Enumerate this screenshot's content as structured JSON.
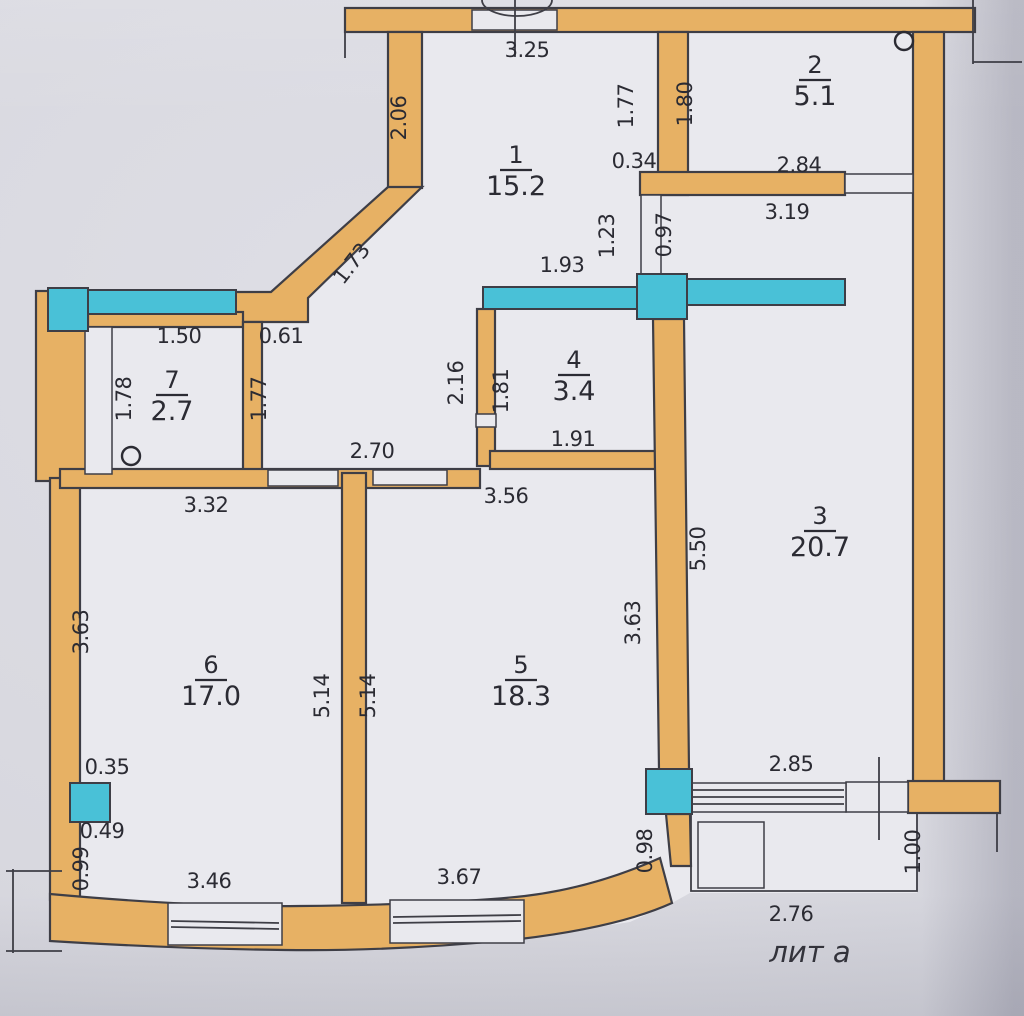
{
  "document": {
    "annotation": "лит а"
  },
  "plan": {
    "colors": {
      "wall": "#e7b164",
      "glazing": "#49c1d7",
      "paper": "#d8d8df",
      "interior": "#e9e9ee",
      "line": "#3e3e46"
    },
    "rooms": [
      {
        "number": "1",
        "area": "15.2",
        "x": 516,
        "y": 163
      },
      {
        "number": "2",
        "area": "5.1",
        "x": 815,
        "y": 73
      },
      {
        "number": "3",
        "area": "20.7",
        "x": 820,
        "y": 524
      },
      {
        "number": "4",
        "area": "3.4",
        "x": 574,
        "y": 368
      },
      {
        "number": "5",
        "area": "18.3",
        "x": 521,
        "y": 673
      },
      {
        "number": "6",
        "area": "17.0",
        "x": 211,
        "y": 673
      },
      {
        "number": "7",
        "area": "2.7",
        "x": 172,
        "y": 388
      }
    ],
    "dimensions": [
      {
        "text": "3.25",
        "x": 527,
        "y": 57
      },
      {
        "text": "2.06",
        "x": 406,
        "y": 118,
        "r": -90
      },
      {
        "text": "1.77",
        "x": 633,
        "y": 106,
        "r": -90
      },
      {
        "text": "0.34",
        "x": 634,
        "y": 168
      },
      {
        "text": "1.80",
        "x": 692,
        "y": 104,
        "r": -90
      },
      {
        "text": "2.84",
        "x": 799,
        "y": 172
      },
      {
        "text": "3.19",
        "x": 787,
        "y": 219
      },
      {
        "text": "1.23",
        "x": 614,
        "y": 236,
        "r": -90
      },
      {
        "text": "0.97",
        "x": 671,
        "y": 235,
        "r": -90
      },
      {
        "text": "1.93",
        "x": 562,
        "y": 272
      },
      {
        "text": "1.73",
        "x": 357,
        "y": 268,
        "r": -52
      },
      {
        "text": "1.50",
        "x": 179,
        "y": 343
      },
      {
        "text": "0.61",
        "x": 281,
        "y": 343
      },
      {
        "text": "1.78",
        "x": 131,
        "y": 399,
        "r": -90
      },
      {
        "text": "1.77",
        "x": 266,
        "y": 399,
        "r": -90
      },
      {
        "text": "2.16",
        "x": 463,
        "y": 383,
        "r": -90
      },
      {
        "text": "1.81",
        "x": 508,
        "y": 391,
        "r": -90
      },
      {
        "text": "1.91",
        "x": 573,
        "y": 446
      },
      {
        "text": "2.70",
        "x": 372,
        "y": 458
      },
      {
        "text": "3.32",
        "x": 206,
        "y": 512
      },
      {
        "text": "3.56",
        "x": 506,
        "y": 503
      },
      {
        "text": "5.50",
        "x": 705,
        "y": 549,
        "r": -90
      },
      {
        "text": "3.63",
        "x": 88,
        "y": 632,
        "r": -90
      },
      {
        "text": "5.14",
        "x": 329,
        "y": 696,
        "r": -90
      },
      {
        "text": "5.14",
        "x": 375,
        "y": 696,
        "r": -90
      },
      {
        "text": "3.63",
        "x": 640,
        "y": 623,
        "r": -90
      },
      {
        "text": "0.35",
        "x": 107,
        "y": 774
      },
      {
        "text": "0.49",
        "x": 102,
        "y": 838
      },
      {
        "text": "0.99",
        "x": 88,
        "y": 869,
        "r": -90
      },
      {
        "text": "3.46",
        "x": 209,
        "y": 888
      },
      {
        "text": "3.67",
        "x": 459,
        "y": 884
      },
      {
        "text": "0.98",
        "x": 652,
        "y": 851,
        "r": -90
      },
      {
        "text": "2.85",
        "x": 791,
        "y": 771
      },
      {
        "text": "1.00",
        "x": 920,
        "y": 852,
        "r": -90
      },
      {
        "text": "2.76",
        "x": 791,
        "y": 921
      }
    ],
    "symbols": [
      {
        "name": "circle-marker",
        "x": 904,
        "y": 41
      },
      {
        "name": "circle-marker",
        "x": 131,
        "y": 456
      }
    ]
  }
}
